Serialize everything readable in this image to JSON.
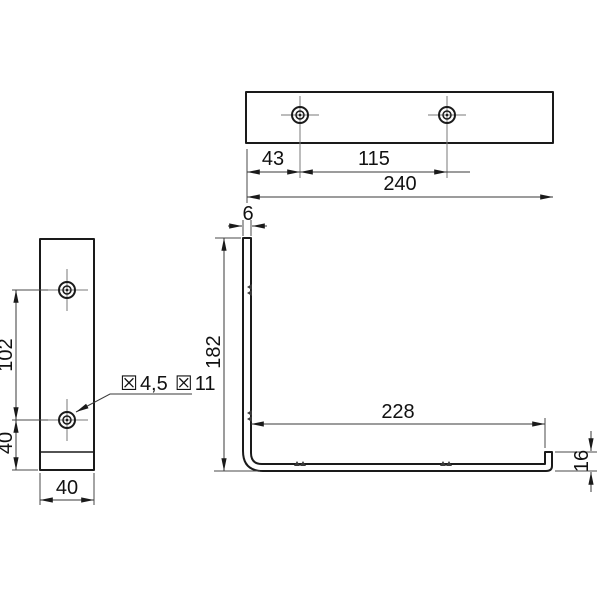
{
  "drawing": {
    "background_color": "#ffffff",
    "line_color": "#1a1a1a",
    "views": {
      "top": {
        "dim_hole_offset": "43",
        "dim_hole_spacing": "115",
        "dim_total_length": "240"
      },
      "front": {
        "dim_hole_to_hole": "102",
        "dim_hole_to_bottom": "40",
        "dim_width": "40",
        "callout": {
          "dia_symbol_1": "☒",
          "drill_value": "4,5",
          "dia_symbol_2": "☒",
          "bore_value": "11"
        }
      },
      "side": {
        "dim_thickness": "6",
        "dim_height": "182",
        "dim_inner_length": "228",
        "dim_lip_height": "16"
      }
    }
  }
}
